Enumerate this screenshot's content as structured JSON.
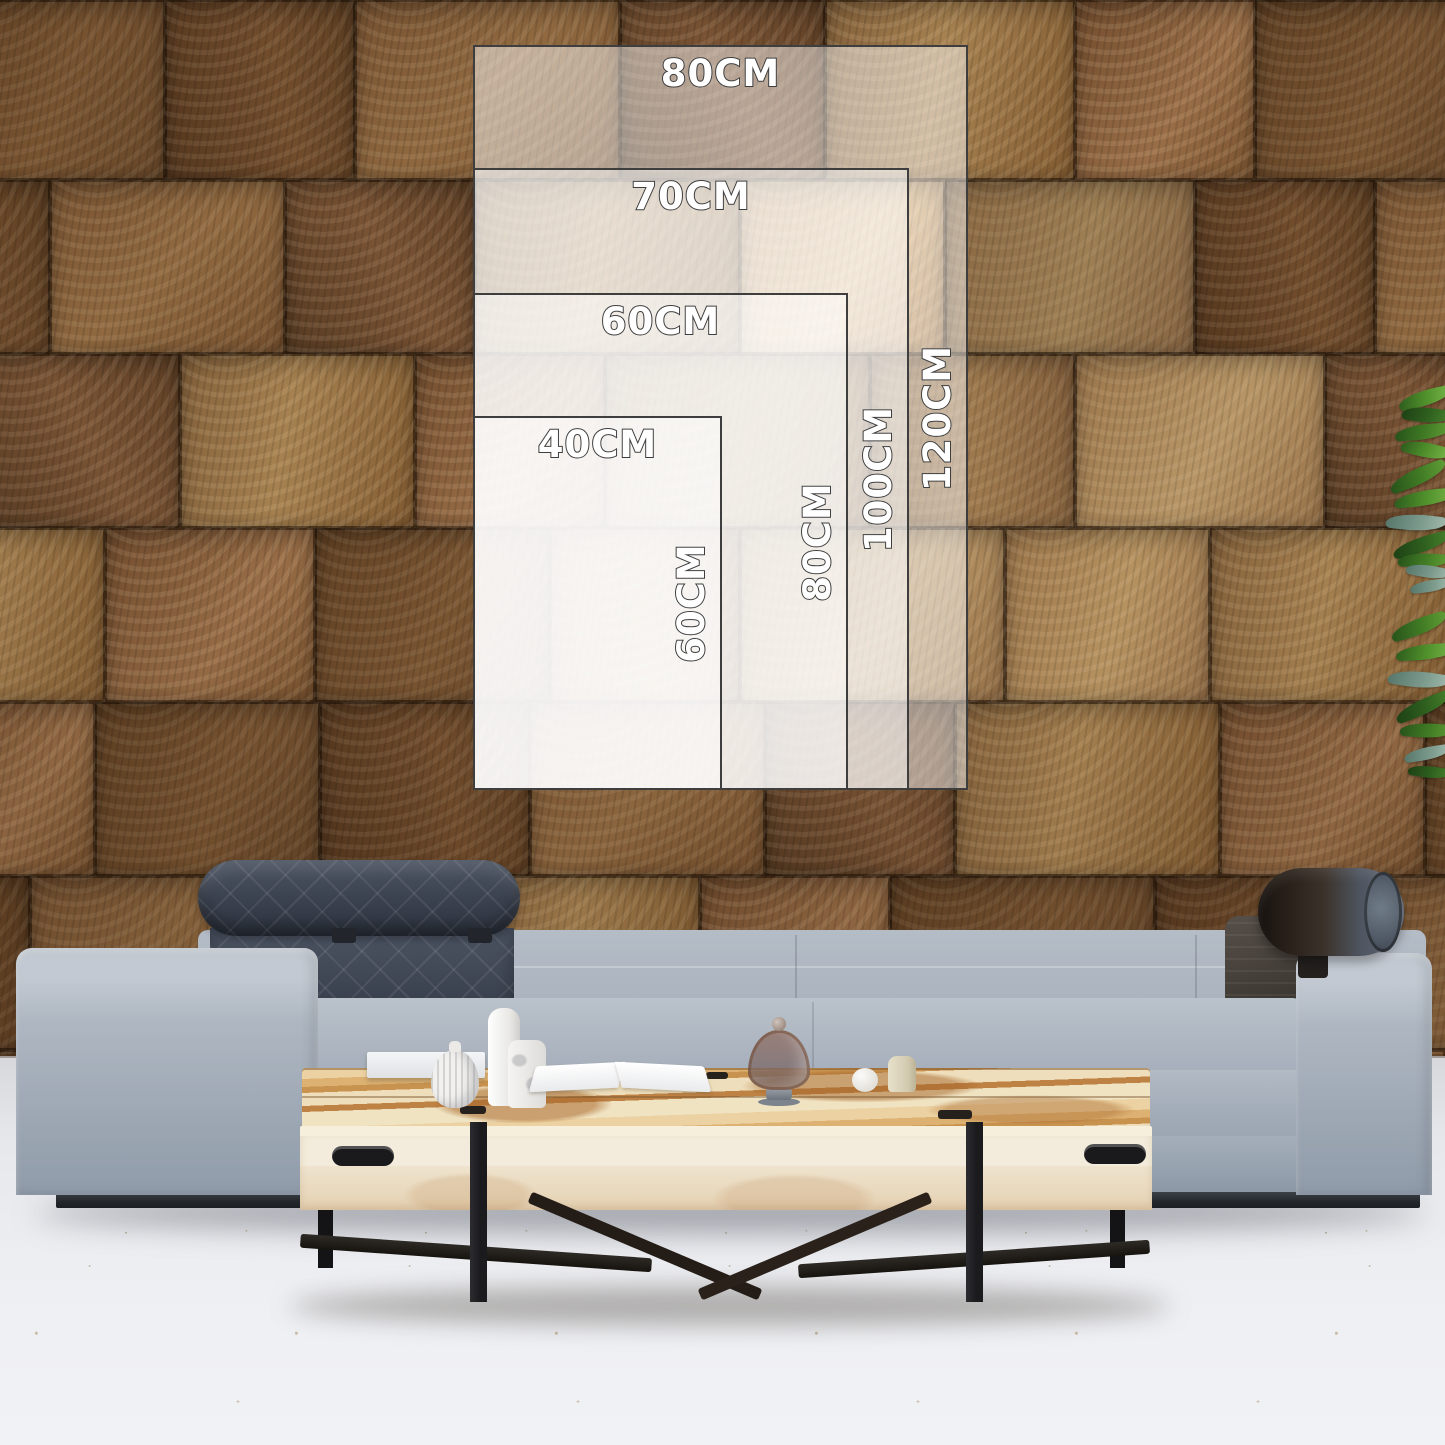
{
  "size_guide": {
    "anchor_corner": "bottom-left",
    "px_per_cm": 6.2,
    "overlay_fill": "rgba(255,255,255,0.48)",
    "outline_color": "#3e3e3e",
    "label_color": "#ffffff",
    "sizes": [
      {
        "width_cm": 80,
        "height_cm": 120,
        "width_label": "80CM",
        "height_label": "120CM"
      },
      {
        "width_cm": 70,
        "height_cm": 100,
        "width_label": "70CM",
        "height_label": "100CM"
      },
      {
        "width_cm": 60,
        "height_cm": 80,
        "width_label": "60CM",
        "height_label": "80CM"
      },
      {
        "width_cm": 40,
        "height_cm": 60,
        "width_label": "40CM",
        "height_label": "60CM"
      }
    ]
  },
  "scene": {
    "colors": {
      "wood_wall": "#7a5636",
      "floor": "#eceff3",
      "sofa_fabric": "#a9b2bd",
      "headrest_quilt": "#3d4450",
      "bolster_leather": "#3a2e26",
      "table_top_wood": "#ddb276",
      "table_body_wood": "#efe4cd",
      "plant_green": "#4c8a2e"
    }
  }
}
